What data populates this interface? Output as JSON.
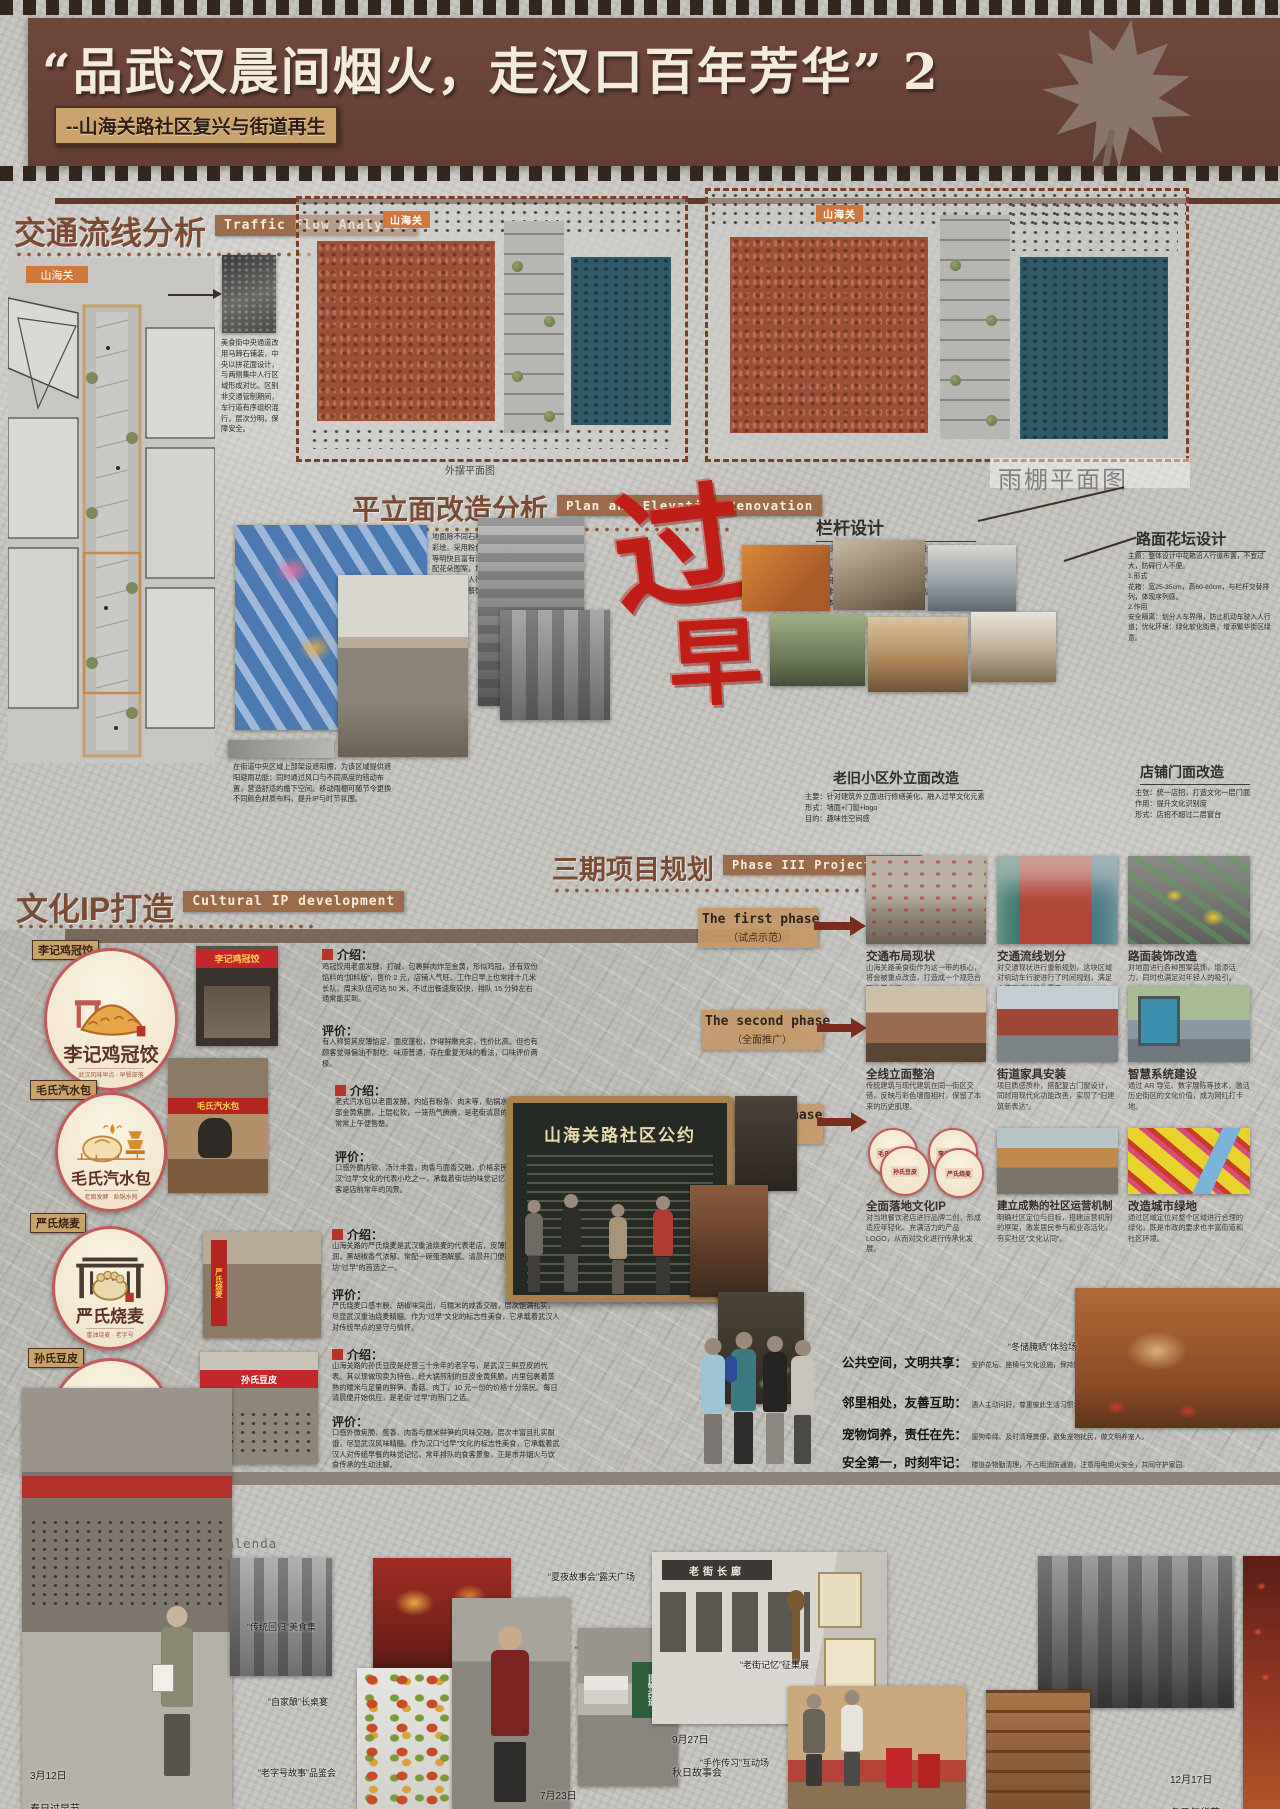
{
  "header": {
    "title": "“品武汉晨间烟火，走汉口百年芳华” 2",
    "subtitle": "--山海关路社区复兴与街道再生"
  },
  "traffic": {
    "title": "交通流线分析",
    "title_en": "Traffic Flow Analysis",
    "flag": "山海关",
    "note": "美食街中央通道改用马蹄石铺装，中央以拼花面设计，与两侧集中人行区域形成对比。区别非交通管制期间，车行道有序组织混行，层次分明，保障安全。",
    "caption_a": "外摆平面图",
    "caption_b": "雨棚平面图"
  },
  "renovation": {
    "title": "平立面改造分析",
    "title_en": "Plan and Elevation Renovation",
    "ground_note": "地面除不同石材铺装外，增加彩绘。采用粉色、黄色、蓝色等明快且富有活力的色彩，搭配花朵图案，增强视觉吸引力；同时对人行与车行流线划分，对热门餐饮店进行人流指引。",
    "canopy_note": "在街道中央区域上部架设遮阳棚，为该区域提供遮阳避雨功能；同时通过风口与不同高度的错动布置，营造舒适的檐下空间。移动雨棚可随节令更换不同颜色材质布料，提升IP与时节氛围。",
    "guozao_1": "过",
    "guozao_2": "早",
    "railing_title": "栏杆设计",
    "railing_note": "具体形式：栏杆采用单杆、组合式设计，杆体直径控制在5-8cm，整体宽度不超过10cm。材质优先选择棕色调金属，可选配简洁通透的玻璃面板，避免装饰占用空间。组合方式：以“1段栏杆+1个花箱”为基础单元循环排列，单元长度按路段调整，高度为1.5-2m，避免整体过宽影响通行。",
    "flowerbed_title": "路面花坛设计",
    "flowerbed_note": "主题：整体设计中花箱沿人行道布置，不宜过大，防碍行人不便。\n1.形式\n花箱：宽25-35cm，高60-80cm，与栏杆交替排列，体现序列感。\n2.作用\n安全隔离：划分人车界限，防止机动车驶入人行道；优化环境：绿化软化街景，增添繁华街区绿意。",
    "label_old": "老旧小区外立面改造",
    "label_old_note": "主要：针对建筑外立面进行修缮美化，融入过早文化元素\n形式：墙面+门窗+logo\n目的：趣味性空间感",
    "label_shop": "店铺门面改造",
    "label_shop_note": "主张：统一店招，打造文化一层门面\n作用：提升文化识别度\n形式：店招不超过二层窗台"
  },
  "cultural": {
    "title": "文化IP打造",
    "title_en": "Cultural IP development",
    "intro_label": "介绍：",
    "eval_label": "评价：",
    "items": [
      {
        "name": "李记鸡冠饺",
        "tag": "武汉风味早点 · 早餐部落",
        "sign": "李记鸡冠饺",
        "intro": "鸡冠饺用老面发酵，打碱，包裹鲜肉炸至金黄，形似鸡冠，还有双份馅料的“加料版”，售价 2 元，店铺人气旺。工作日早上也常排十几米长队，周末队伍可达 50 米，不过出餐速度较快，排队 15 分钟左右通常能买到。",
        "eval": "有人称赞其皮薄馅足、面皮蓬松，炸得鲜嫩充实，性价比高。但也有顾客觉得偏油不耐吃、味道普通，存在重复无味的看法，口味评价两极。"
      },
      {
        "name": "毛氏汽水包",
        "tag": "老面发酵 · 贴锅水煎",
        "sign": "毛氏汽水包",
        "intro": "老式汽水包以老面发酵，内馅有粉条、肉末等，贴锅水煎而成，底部金黄焦脆，上层松软，一笼热气腾腾，是老街清晨的招牌香气，常常上午便售罄。",
        "eval": "口感外脆内软、汤汁丰盈，肉香与面香交融，价格亲民，是武汉“过早”文化的代表小吃之一，承载着街坊的味觉记忆，排队的食客是店前常年的风景。"
      },
      {
        "name": "严氏烧麦",
        "tag": "重油烧麦 · 老字号",
        "sign": "严氏烧麦",
        "intro": "山海关路的严氏烧麦是武汉重油烧麦的代表老店，皮薄馅足，糯米油润，黑胡椒香气浓郁，常配一碗蛋酒解腻。清晨开门便排起长队，是街坊“过早”的首选之一。",
        "eval": "严氏烧麦口感丰腴、胡椒味突出，与糯米的咸香交融，层次饱满扎实，尽显武汉重油烧麦精髓。作为“过早”文化的标志性美食，它承载着武汉人对传统早点的坚守与情怀。"
      },
      {
        "name": "孙氏豆皮",
        "tag": "金黄·糯米·鲜笋·肉丁馅",
        "sign": "孙氏豆皮",
        "intro": "山海关路的孙氏豆皮是经营三十余年的老字号，是武汉三鲜豆皮的代表。其以现做现卖为特色，经大锅煎制的豆皮金黄焦脆，内里包裹着蒸熟的糯米与足量的鲜笋、香菇、肉丁，10 元一份的价格十分亲民。每日清晨便开始供应，是老街“过早”的热门之选。",
        "eval": "口感外微焦脆，蛋香、肉香与糯米鲜笋的风味交融，层次丰富且扎实耐饿，尽显武汉风味精髓。作为汉口“过早”文化的标志性美食，它承载着武汉人对传统早餐的味觉记忆，常年排队的食客景象，正是市井烟火与饮食传承的生动注脚。"
      }
    ]
  },
  "phases": {
    "title": "三期项目规划",
    "title_en": "Phase III Project Plan",
    "list": [
      {
        "en": "The first phase",
        "zh": "（试点示范）"
      },
      {
        "en": "The second phase",
        "zh": "（全面推广）"
      },
      {
        "en": "The third phase",
        "zh": "（文化深耕）"
      }
    ],
    "cards": [
      {
        "t": "交通布局现状",
        "b": "山海关路美食街作为这一带的核心，将会被重点改造，打造成一个规范合理的美食街。"
      },
      {
        "t": "交通流线划分",
        "b": "对交通现状进行重新规划，这块区域对机动车行驶进行了时间规划，满足人流高峰时段的需要。"
      },
      {
        "t": "路面装饰改造",
        "b": "对地面进行各种图案装饰，增添活力，同时也满足对年轻人的吸引。"
      },
      {
        "t": "全线立面整治",
        "b": "传统建筑与现代建筑在同一街区交错，反映与彩色墙面相衬，保留了本来的历史肌理。"
      },
      {
        "t": "街道家具安装",
        "b": "项目质感质朴，搭配复古门窗设计，同时用现代化功能改善，实现了“旧建筑新表达”。"
      },
      {
        "t": "智慧系统建设",
        "b": "通过 AR 导览、数字展陈等技术，激活历史街区的文化价值，成为网红打卡地。"
      },
      {
        "t": "全面落地文化IP",
        "b": "对当地餐饮老店进行品牌二创，形成适应年轻化、充满活力的产品LOGO，从而对文化进行传承化发展。"
      },
      {
        "t": "建立成熟的社区运营机制",
        "b": "明确社区定位与目标，搭建运营机制的框架，激发居民参与和业态活化，夯实社区“文化认同”。"
      },
      {
        "t": "改造城市绿地",
        "b": "通过区域定位对整个区域进行合理的绿化，既是市政的要求也丰富街道和社区环境。"
      }
    ],
    "board_title": "山海关路社区公约",
    "convention": [
      {
        "h": "公共空间，文明共享：",
        "b": "爱护花坛、座椅与文化设施，保持整洁，不占用、不私搭，共同维护好环境。"
      },
      {
        "h": "邻里相处，友善互助：",
        "b": "遇人主动问好，尊重彼此生活习惯；若有矛盾，多沟通协商，共建温馨社区。"
      },
      {
        "h": "宠物饲养，责任在先：",
        "b": "遛狗牵绳、及时清理粪便，避免宠物扰民，做文明养宠人。"
      },
      {
        "h": "安全第一，时刻牢记：",
        "b": "楼道杂物勤清理，不占用消防通道，注意用电用火安全，共同守护家园。"
      }
    ],
    "mini_ips": [
      "毛氏汽水包",
      "李记鸡冠饺",
      "孙氏豆皮",
      "严氏烧麦"
    ]
  },
  "calendar": {
    "title": "四季活动日历",
    "title_en": "Four Seasons Activity Calenda",
    "events": [
      {
        "date": "3月12日",
        "name": "春日过早节"
      },
      {
        "date": "7月23日",
        "name": "夏日邻里宴"
      },
      {
        "date": "9月27日",
        "name": "秋日故事会"
      },
      {
        "date": "12月17日",
        "name": "冬日年货节"
      }
    ],
    "labels": [
      "“传统回归”美食集",
      "“自家酿”长桌宴",
      "“老字号故事”品鉴会",
      "“夏夜故事会”露天广场",
      "“冰爽一夏”补给点",
      "“老街记忆”征集展",
      "“手作传习”互动场",
      "“冬储腌晒”体验场"
    ],
    "sign_wall": "老街长廊",
    "sign_board": "旧物改造"
  }
}
